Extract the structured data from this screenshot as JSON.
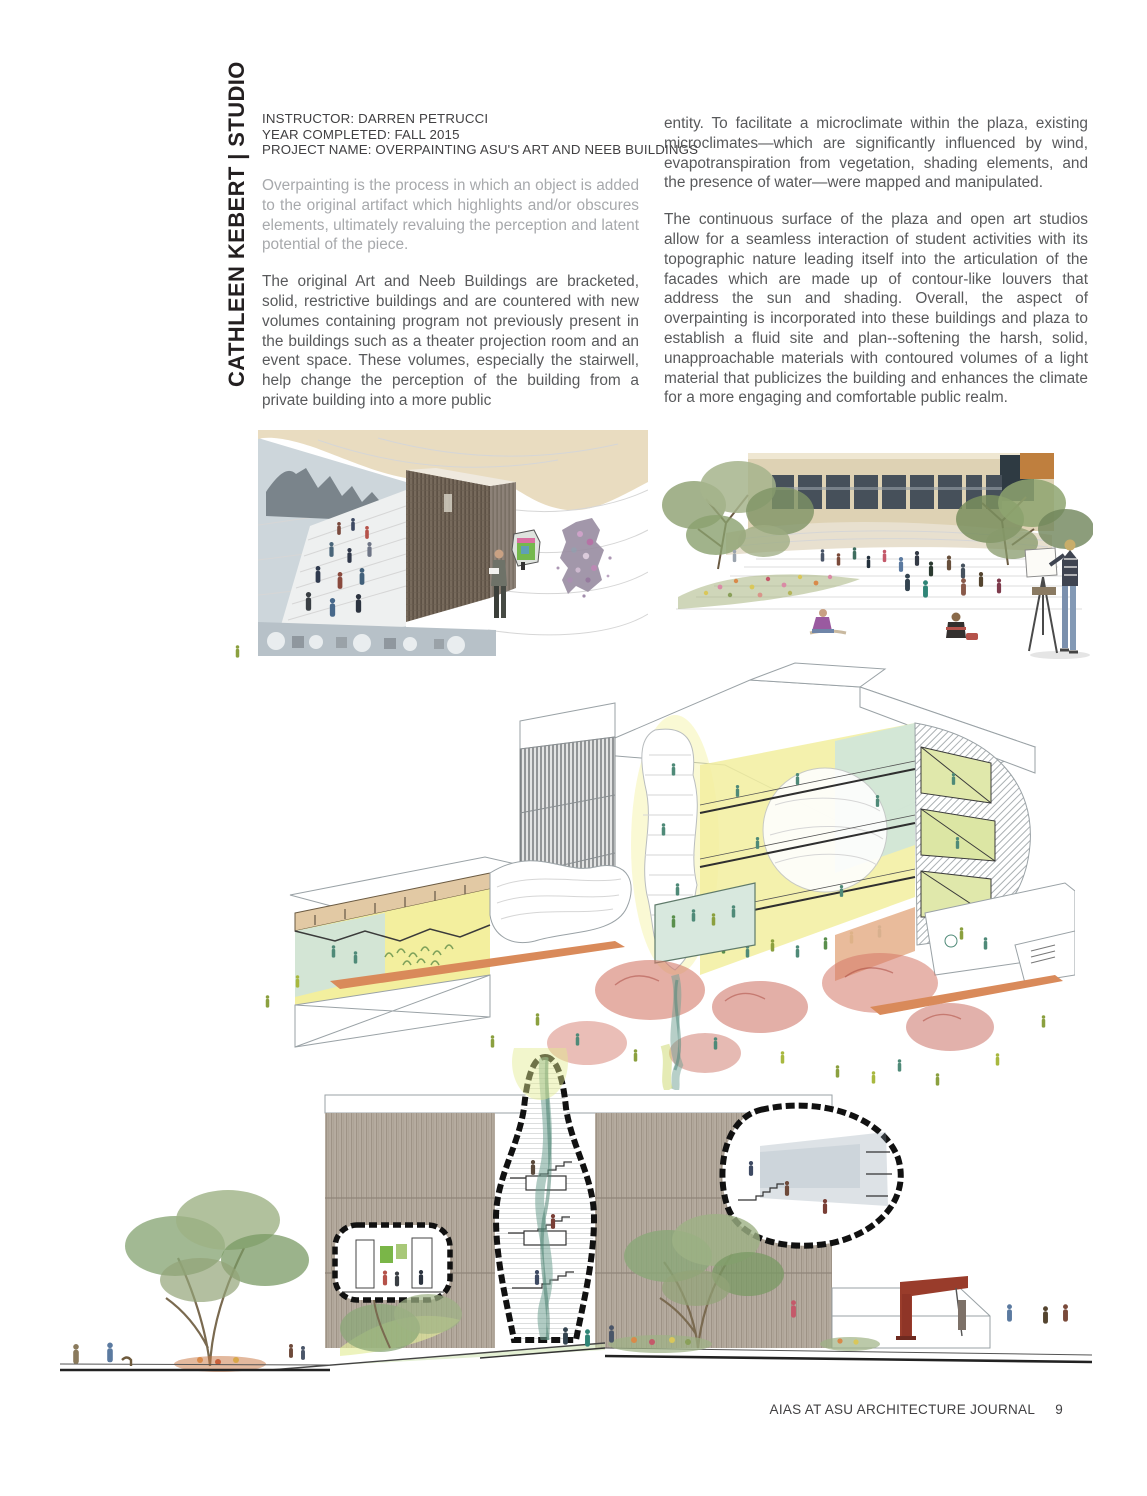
{
  "page": {
    "sidebar_title": "CATHLEEN KEBERT | STUDIO",
    "meta": {
      "instructor": "INSTRUCTOR: DARREN PETRUCCI",
      "year": "YEAR COMPLETED: FALL 2015",
      "project": "PROJECT NAME: OVERPAINTING ASU'S ART AND NEEB BUILDINGS"
    },
    "left_column": {
      "intro": "Overpainting is the process in which an object is added to the original artifact which highlights and/or obscures elements, ultimately revaluing the perception and latent potential of the piece.",
      "body": "The original Art and Neeb Buildings are bracketed, solid, restrictive buildings and are countered with new volumes containing program not previously present in the buildings such as a theater projection room and an event space. These volumes, especially the stairwell, help change the perception of the building from a private building into a more public"
    },
    "right_column": {
      "para1": "entity. To facilitate a microclimate within the plaza, existing microclimates—which are significantly influenced by wind, evapotranspiration from vegetation, shading elements, and the presence of water—were mapped and manipulated.",
      "para2": "The continuous surface of the plaza and open art studios allow for a seamless interaction of student activities with its topographic nature leading itself into the articulation of the facades which are made up of contour-like louvers that address the sun and shading. Overall, the aspect of overpainting is incorporated into these buildings and plaza to establish a fluid site and plan--softening the harsh, solid, unapproachable materials with contoured volumes of a light material that publicizes the building and enhances the climate for a more engaging and comfortable public realm."
    },
    "figures": {
      "fig1": "Interior perspective - amphitheater stair, wood stairwell volume and gallery wall",
      "fig2": "Plaza perspective - students, trees and painter at easel in front of building",
      "fig3": "Axonometric cutaway - overpainted Art and Neeb buildings with plaza landscape",
      "fig4": "Site elevation - sectional stairwell volumes cut through slatted facade"
    },
    "footer": {
      "journal": "AIAS AT ASU ARCHITECTURE JOURNAL",
      "page_number": "9"
    },
    "colors": {
      "title_black": "#231f20",
      "meta_gray": "#414042",
      "intro_gray": "#a7a9ac",
      "body_gray": "#58595b",
      "ceiling_tan": "#e9dcc0",
      "wall_blue_gray": "#cdd6db",
      "wood_brown": "#6d6257",
      "facade_tan": "#b3a89b",
      "cut_yellow": "#f2ee9f",
      "cut_mint": "#d2e7da",
      "tree_coral": "#d4796a",
      "tree_green": "#8ba06e",
      "crane_red": "#993c2b",
      "smoke_teal": "#6fa092",
      "wash_yellow_green": "#dfe89a"
    }
  }
}
